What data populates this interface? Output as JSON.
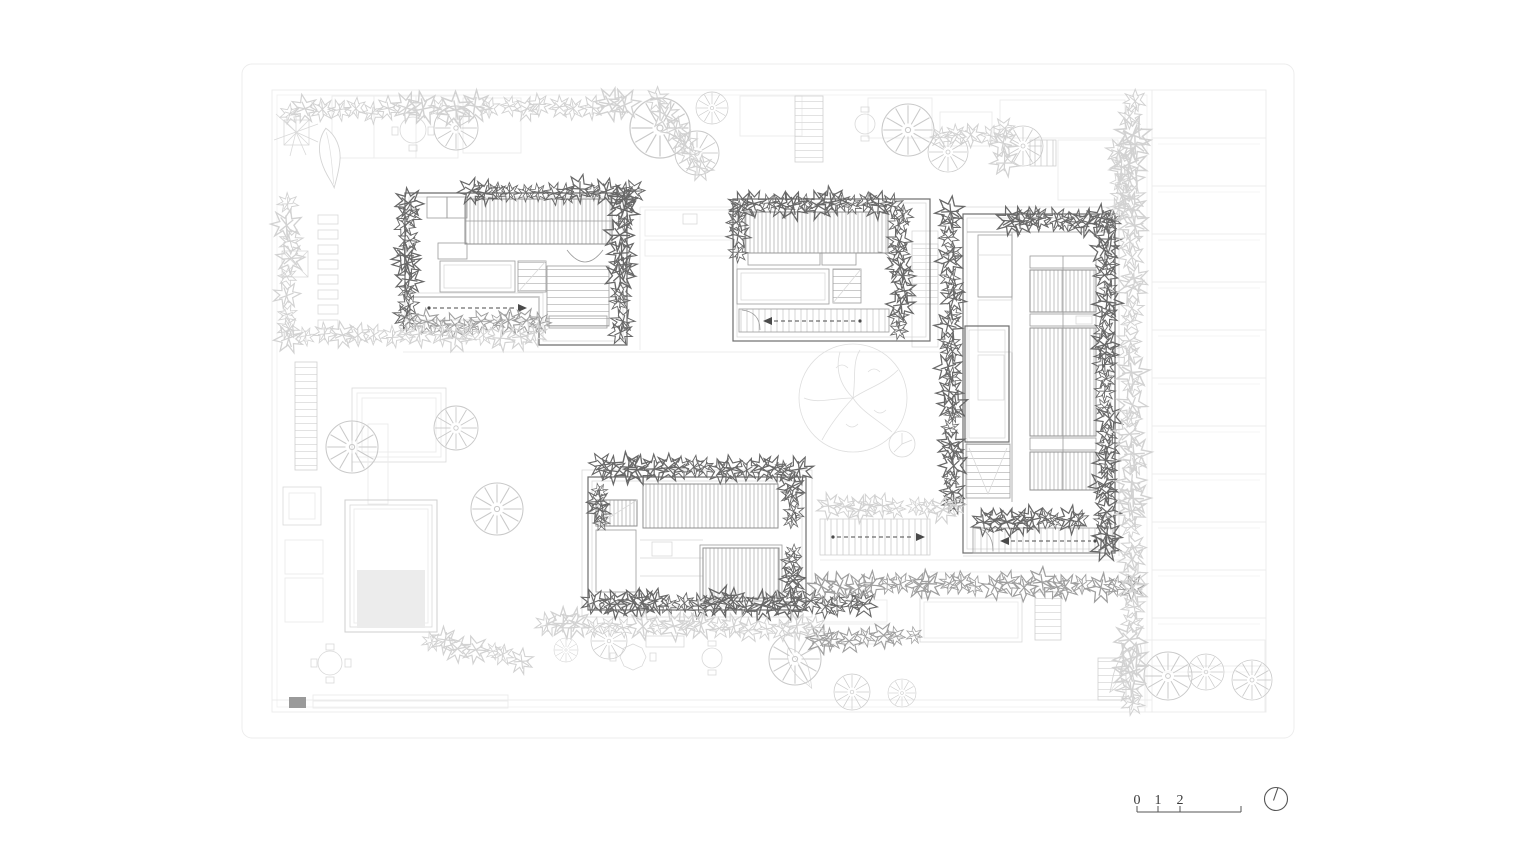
{
  "drawing": {
    "kind": "architectural roof/site plan",
    "sheet": "rounded rectangular sheet border",
    "buildings": {
      "northwest": "L-shaped pavilion with slatted roof deck, pool and stairs",
      "north": "rectangular pavilion with slatted roof deck, pool, stairs and entry corridor",
      "east": "tall pavilion with slatted roof panels, core, stairs and entry corridor",
      "south": "rectangular pavilion with slatted roof decks and planted perimeter"
    },
    "landscape": "courtyard gardens with trees, ponds, terraces, tables and planted edges"
  },
  "scale_bar": {
    "labels": [
      "0",
      "1",
      "2",
      "5"
    ]
  },
  "north_arrow": {
    "type": "circle with needle"
  },
  "colors": {
    "background": "#ffffff",
    "wall_line": "#6d6d6d",
    "medium_line": "#9b9b9b",
    "light_line": "#d9d9d9",
    "vegetation_dark": "#686868",
    "vegetation_medium": "#9f9f9f",
    "vegetation_light": "#d2d2d2",
    "text": "#3a3a3a"
  }
}
